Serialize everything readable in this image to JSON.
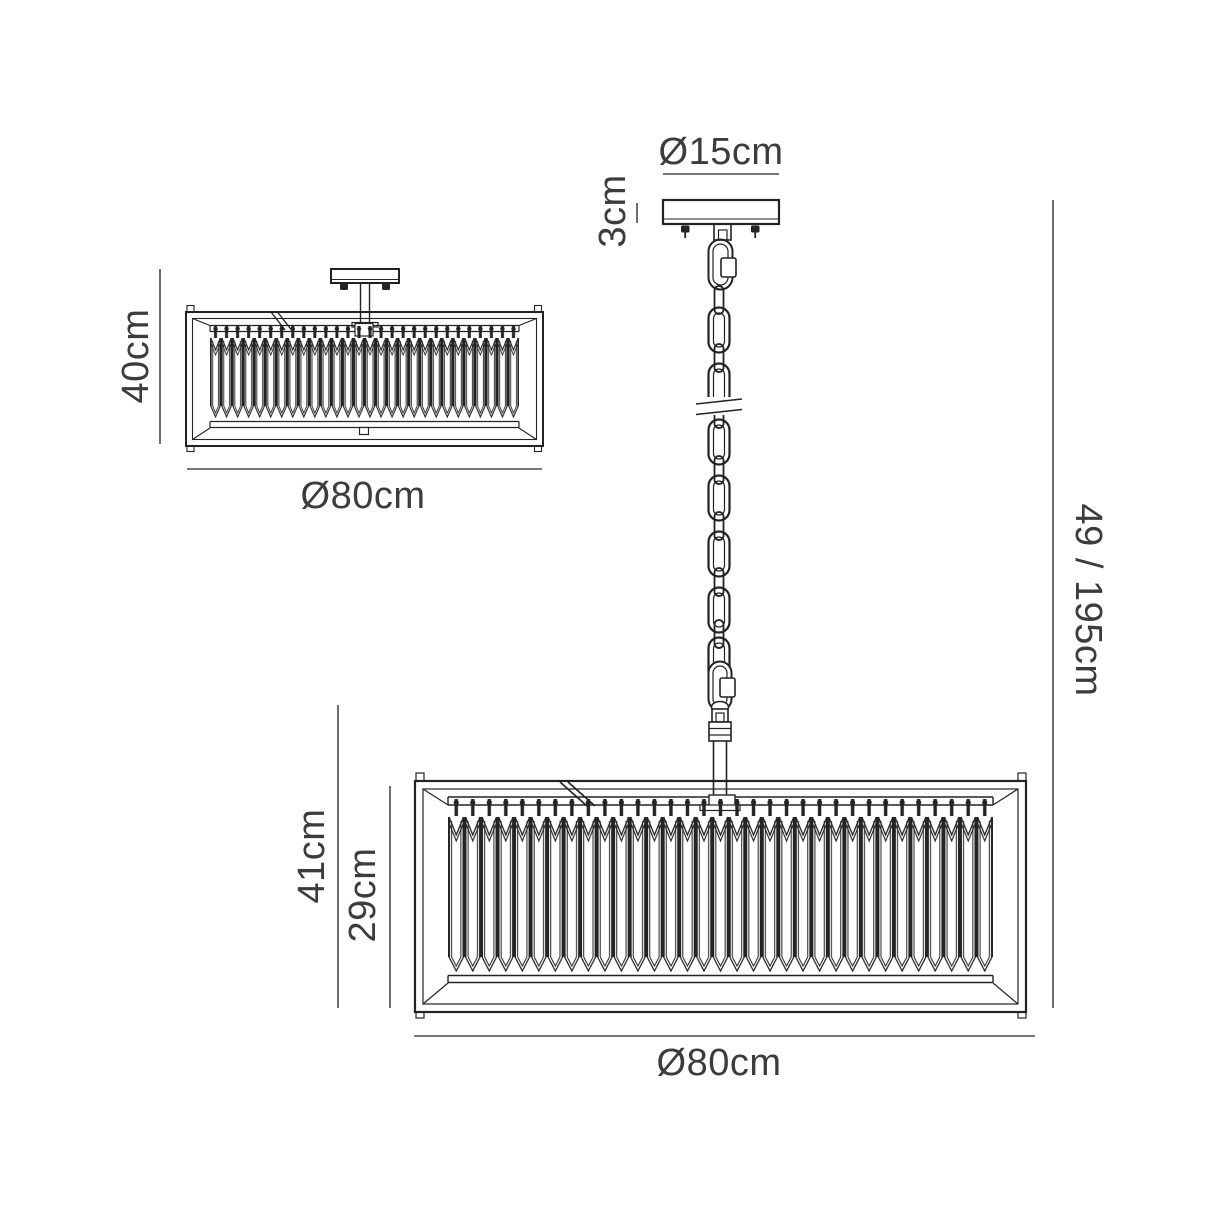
{
  "diagram": {
    "type": "lighting-fixture-dimension-drawing",
    "views": {
      "pendant": {
        "canopy_diameter_label": "Ø15cm",
        "canopy_height_label": "3cm",
        "total_drop_label": "49 / 195cm",
        "body_height_outer_label": "41cm",
        "body_height_inner_label": "29cm",
        "width_label": "Ø80cm"
      },
      "semi_flush": {
        "height_label": "40cm",
        "width_label": "Ø80cm"
      }
    },
    "colors": {
      "line": "#232323",
      "dimension_line": "#4a4a4a",
      "text": "#3c3c3c",
      "background": "#ffffff"
    }
  }
}
